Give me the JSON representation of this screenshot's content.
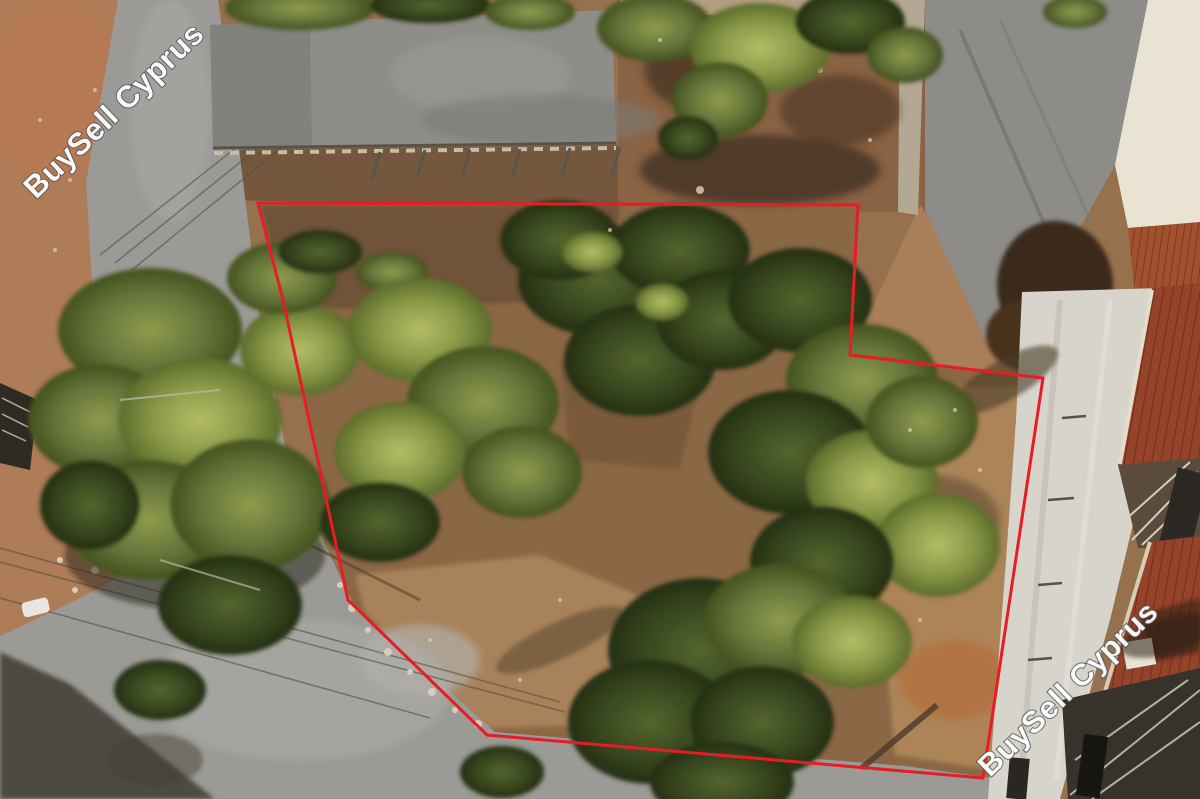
{
  "image": {
    "type": "aerial-drone-photo",
    "subject": "land plot for sale outlined in red, trees, dirt roads and buildings",
    "brand": "BuySell Cyprus"
  },
  "watermarks": {
    "color": "#ffffff",
    "outline_color": "#4c4c4c",
    "top_left": {
      "text": "BuySell Cyprus"
    },
    "bottom_right": {
      "text": "BuySell Cyprus"
    }
  },
  "overlay": {
    "boundary_color": "#e81c24",
    "boundary_points": [
      [
        258,
        203
      ],
      [
        858,
        205
      ],
      [
        850,
        355
      ],
      [
        1043,
        378
      ],
      [
        983,
        778
      ],
      [
        487,
        735
      ],
      [
        348,
        600
      ],
      [
        283,
        300
      ]
    ]
  },
  "palette": {
    "dirt_tan": "#a87f58",
    "dirt_red": "#b07050",
    "road_gray": "#9c9a96",
    "roof_gray": "#8e8d89",
    "concrete_light": "#d7d4cb",
    "terracotta": "#95432a",
    "white_building": "#e9e3d3",
    "pine_dark": "#39471f",
    "olive_green": "#65743a",
    "bright_green": "#8b9a48"
  }
}
